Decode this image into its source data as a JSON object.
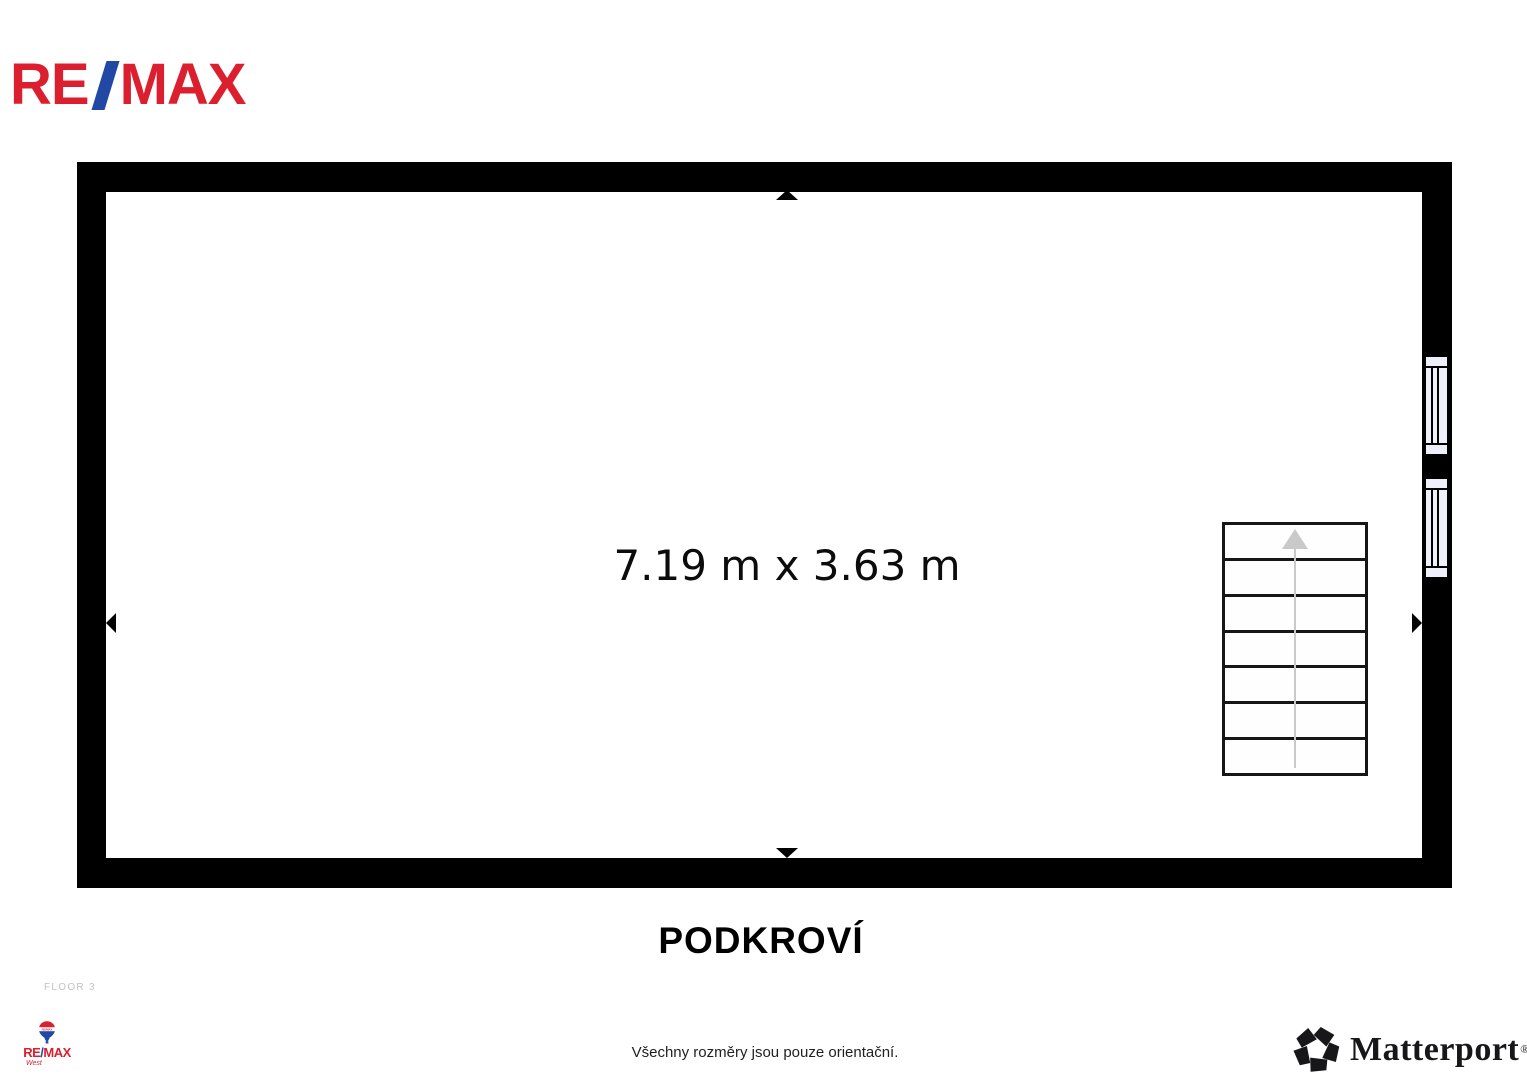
{
  "header": {
    "logo": {
      "re": "RE",
      "slash": "/",
      "max": "MAX"
    }
  },
  "floorplan": {
    "dimension_label": "7.19 m x 3.63 m",
    "title": "PODKROVÍ",
    "stairs": {
      "steps": 7,
      "direction": "up"
    },
    "windows_count": 2
  },
  "footer": {
    "floor_indicator": "FLOOR 3",
    "disclaimer": "Všechny rozměry jsou pouze orientační.",
    "agency": {
      "balloon_text": "RE/MAX",
      "re": "RE",
      "slash": "/",
      "max": "MAX",
      "sub": "West"
    },
    "matterport": {
      "name": "Matterport",
      "reg": "®"
    }
  },
  "colors": {
    "remax_red": "#DC1F2E",
    "remax_blue": "#2148A4",
    "wall": "#000000",
    "window_fill": "#EDEFFA",
    "stair_line": "#161616",
    "stair_arrow": "#C9C9C9",
    "floor_indicator_gray": "#C3C3C3",
    "matterport_black": "#17171A"
  }
}
